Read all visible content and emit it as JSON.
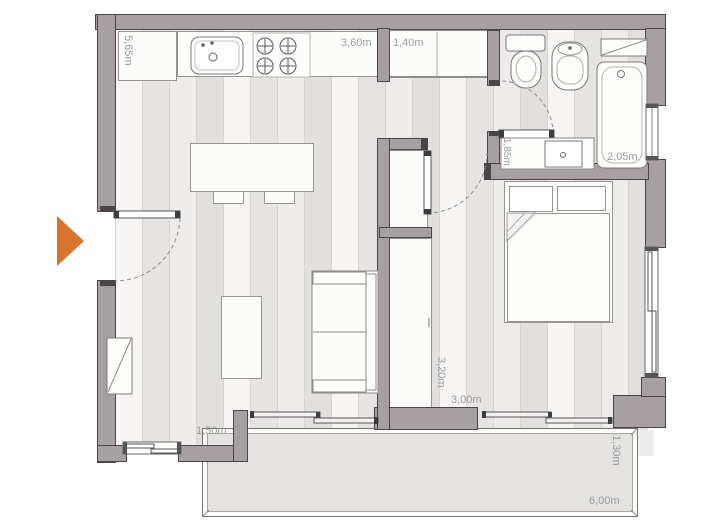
{
  "type": "apartment-floor-plan",
  "colors": {
    "wall": "#a6a0a2",
    "wall-dark": "#4a4347",
    "accent": "#d97430",
    "floor-base": "#ebe9e7",
    "plank-line": "#d7d4d1",
    "balcony": "#e4e3e2",
    "label": "#9b9b9b"
  },
  "dimensions": {
    "kitchen_side": "5,65m",
    "kitchen_counter": "3,60m",
    "entry_closet": "1,40m",
    "bath_vanity": "1,85m",
    "bathtub": "2,05m",
    "bedroom_depth": "3,20m",
    "bedroom_width": "3,00m",
    "living_window": "1,50m",
    "balcony_depth": "1,30m",
    "balcony_width": "6,00m"
  }
}
